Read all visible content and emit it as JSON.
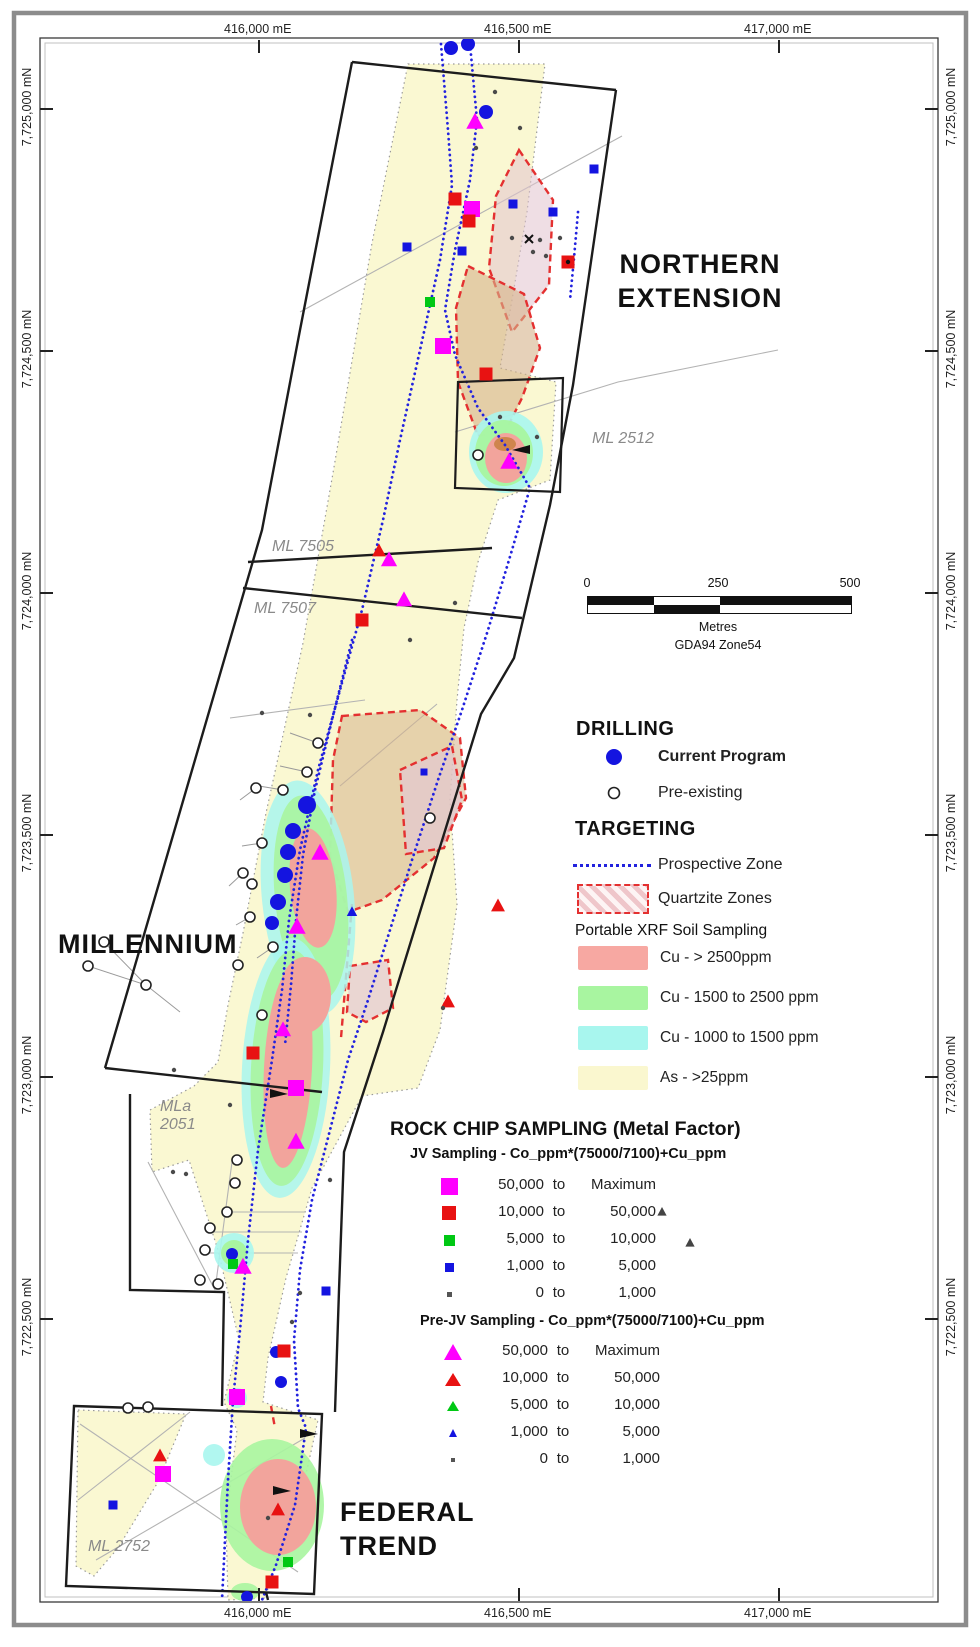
{
  "figure": {
    "areas": {
      "northern": [
        "NORTHERN",
        "EXTENSION"
      ],
      "millennium": "MILLENNIUM",
      "federal": [
        "FEDERAL",
        "TREND"
      ]
    },
    "leases": {
      "ml2512": "ML 2512",
      "ml7505": "ML 7505",
      "ml7507": "ML 7507",
      "mla2051": [
        "MLa",
        "2051"
      ],
      "ml2752": "ML 2752"
    }
  },
  "axes": {
    "eastings": [
      {
        "label": "416,000 mE",
        "x": 258
      },
      {
        "label": "416,500 mE",
        "x": 518
      },
      {
        "label": "417,000 mE",
        "x": 778
      }
    ],
    "northings": [
      {
        "label": "7,725,000 mN",
        "y": 108
      },
      {
        "label": "7,724,500 mN",
        "y": 350
      },
      {
        "label": "7,724,000 mN",
        "y": 592
      },
      {
        "label": "7,723,500 mN",
        "y": 834
      },
      {
        "label": "7,723,000 mN",
        "y": 1076
      },
      {
        "label": "7,722,500 mN",
        "y": 1318
      }
    ]
  },
  "scalebar": {
    "ticks": [
      {
        "label": "0",
        "x": 587
      },
      {
        "label": "250",
        "x": 718
      },
      {
        "label": "500",
        "x": 850
      }
    ],
    "unit": "Metres",
    "datum": "GDA94 Zone54"
  },
  "legend": {
    "drilling": {
      "title": "DRILLING",
      "current": "Current Program",
      "preexisting": "Pre-existing"
    },
    "targeting": {
      "title": "TARGETING",
      "prospective": "Prospective Zone",
      "quartzite": "Quartzite Zones",
      "soil_title": "Portable XRF Soil Sampling",
      "soil": [
        {
          "color": "#F7A8A2",
          "label": "Cu - > 2500ppm"
        },
        {
          "color": "#A8F5A0",
          "label": "Cu - 1500 to 2500 ppm"
        },
        {
          "color": "#A8F6EE",
          "label": "Cu - 1000 to 1500 ppm"
        },
        {
          "color": "#FAF7CF",
          "label": "As - >25ppm"
        }
      ]
    },
    "rockchip": {
      "title": "ROCK CHIP SAMPLING (Metal Factor)",
      "joiner": "to",
      "jv": {
        "subtitle": "JV Sampling - Co_ppm*(75000/7100)+Cu_ppm",
        "rows": [
          {
            "a": "50,000",
            "b": "Maximum",
            "color": "#FF00FF",
            "size": 17
          },
          {
            "a": "10,000",
            "b": "50,000",
            "color": "#E81212",
            "size": 14
          },
          {
            "a": "5,000",
            "b": "10,000",
            "color": "#00C814",
            "size": 11
          },
          {
            "a": "1,000",
            "b": "5,000",
            "color": "#1414E0",
            "size": 9
          },
          {
            "a": "0",
            "b": "1,000",
            "color": "#555555",
            "size": 5
          }
        ]
      },
      "prejv": {
        "subtitle": "Pre-JV Sampling - Co_ppm*(75000/7100)+Cu_ppm",
        "rows": [
          {
            "a": "50,000",
            "b": "Maximum",
            "color": "#FF00FF",
            "size": 16
          },
          {
            "a": "10,000",
            "b": "50,000",
            "color": "#E81212",
            "size": 13
          },
          {
            "a": "5,000",
            "b": "10,000",
            "color": "#00C814",
            "size": 10
          },
          {
            "a": "1,000",
            "b": "5,000",
            "color": "#1414E0",
            "size": 8
          },
          {
            "a": "0",
            "b": "1,000",
            "color": "#555555",
            "size": 4
          }
        ]
      }
    }
  },
  "colors": {
    "drill_blue": "#1414E0",
    "prospective_blue": "#2222DE",
    "quartzite_red": "#E43030",
    "soil_pink": "#F7A8A2",
    "soil_green": "#A8F5A0",
    "soil_cyan": "#A8F6EE",
    "soil_yellow": "#FAF8D2",
    "magenta": "#FF00FF",
    "red": "#E81212",
    "green": "#00C814",
    "blue": "#1414E0",
    "gray": "#4a4a4a"
  },
  "map": {
    "markers": [
      [
        "drill",
        451,
        48
      ],
      [
        "drill",
        468,
        44
      ],
      [
        "drill",
        486,
        112
      ],
      [
        "drill",
        307,
        805,
        null,
        9
      ],
      [
        "drill",
        293,
        831,
        null,
        8
      ],
      [
        "drill",
        288,
        852,
        null,
        8
      ],
      [
        "drill",
        285,
        875,
        null,
        8
      ],
      [
        "drill",
        278,
        902,
        null,
        8
      ],
      [
        "drill",
        272,
        923,
        null,
        7
      ],
      [
        "drill",
        232,
        1254,
        null,
        6
      ],
      [
        "drill",
        276,
        1352,
        null,
        6
      ],
      [
        "drill",
        281,
        1382,
        null,
        6
      ],
      [
        "drill",
        247,
        1597,
        null,
        6
      ],
      [
        "open",
        478,
        455
      ],
      [
        "open",
        318,
        743
      ],
      [
        "open",
        307,
        772
      ],
      [
        "open",
        283,
        790
      ],
      [
        "open",
        256,
        788
      ],
      [
        "open",
        262,
        843
      ],
      [
        "open",
        243,
        873
      ],
      [
        "open",
        252,
        884
      ],
      [
        "open",
        250,
        917
      ],
      [
        "open",
        273,
        947
      ],
      [
        "open",
        238,
        965
      ],
      [
        "open",
        430,
        818
      ],
      [
        "open",
        88,
        966
      ],
      [
        "open",
        104,
        942
      ],
      [
        "open",
        146,
        985
      ],
      [
        "open",
        237,
        1160
      ],
      [
        "open",
        235,
        1183
      ],
      [
        "open",
        227,
        1212
      ],
      [
        "open",
        210,
        1228
      ],
      [
        "open",
        205,
        1250
      ],
      [
        "open",
        200,
        1280
      ],
      [
        "open",
        218,
        1284
      ],
      [
        "open",
        128,
        1408
      ],
      [
        "open",
        148,
        1407
      ],
      [
        "open",
        262,
        1015
      ],
      [
        "sq",
        472,
        209,
        "#FF00FF",
        16
      ],
      [
        "sq",
        443,
        346,
        "#FF00FF",
        16
      ],
      [
        "sq",
        296,
        1088,
        "#FF00FF",
        16
      ],
      [
        "sq",
        237,
        1397,
        "#FF00FF",
        16
      ],
      [
        "sq",
        163,
        1474,
        "#FF00FF",
        16
      ],
      [
        "sq",
        455,
        199,
        "#E81212",
        13
      ],
      [
        "sq",
        469,
        221,
        "#E81212",
        13
      ],
      [
        "sq",
        486,
        374,
        "#E81212",
        13
      ],
      [
        "sq",
        568,
        262,
        "#E81212",
        13
      ],
      [
        "sq",
        253,
        1053,
        "#E81212",
        13
      ],
      [
        "sq",
        284,
        1351,
        "#E81212",
        13
      ],
      [
        "sq",
        272,
        1582,
        "#E81212",
        13
      ],
      [
        "sq",
        362,
        620,
        "#E81212",
        13
      ],
      [
        "sq",
        430,
        302,
        "#00C814",
        10
      ],
      [
        "sq",
        233,
        1264,
        "#00C814",
        10
      ],
      [
        "sq",
        288,
        1562,
        "#00C814",
        10
      ],
      [
        "sq",
        407,
        247,
        "#1414E0",
        9
      ],
      [
        "sq",
        462,
        251,
        "#1414E0",
        9
      ],
      [
        "sq",
        513,
        204,
        "#1414E0",
        9
      ],
      [
        "sq",
        553,
        212,
        "#1414E0",
        9
      ],
      [
        "sq",
        594,
        169,
        "#1414E0",
        9
      ],
      [
        "sq",
        326,
        1291,
        "#1414E0",
        9
      ],
      [
        "sq",
        113,
        1505,
        "#1414E0",
        9
      ],
      [
        "sq",
        424,
        772,
        "#1414E0",
        7
      ],
      [
        "tr",
        475,
        122,
        "#FF00FF",
        15
      ],
      [
        "tr",
        320,
        853,
        "#FF00FF",
        15
      ],
      [
        "tr",
        297,
        927,
        "#FF00FF",
        15
      ],
      [
        "tr",
        296,
        1142,
        "#FF00FF",
        15
      ],
      [
        "tr",
        243,
        1267,
        "#FF00FF",
        15
      ],
      [
        "tr",
        509,
        462,
        "#FF00FF",
        15
      ],
      [
        "tr",
        389,
        560,
        "#FF00FF",
        14
      ],
      [
        "tr",
        404,
        600,
        "#FF00FF",
        14
      ],
      [
        "tr",
        283,
        1030,
        "#FF00FF",
        14
      ],
      [
        "tr",
        379,
        551,
        "#E81212",
        12
      ],
      [
        "tr",
        448,
        1002,
        "#E81212",
        12
      ],
      [
        "tr",
        498,
        906,
        "#E81212",
        12
      ],
      [
        "tr",
        278,
        1510,
        "#E81212",
        12
      ],
      [
        "tr",
        160,
        1456,
        "#E81212",
        12
      ],
      [
        "tr",
        352,
        912,
        "#1414E0",
        9
      ],
      [
        "tr",
        662,
        1212,
        "#444444",
        8
      ],
      [
        "tr",
        690,
        1243,
        "#444444",
        8
      ],
      [
        "dot",
        495,
        92
      ],
      [
        "dot",
        520,
        128
      ],
      [
        "dot",
        476,
        148
      ],
      [
        "dot",
        540,
        240
      ],
      [
        "dot",
        533,
        252
      ],
      [
        "dot",
        512,
        238
      ],
      [
        "dot",
        546,
        256
      ],
      [
        "dot",
        560,
        238
      ],
      [
        "dot",
        537,
        437
      ],
      [
        "dot",
        500,
        417
      ],
      [
        "dot",
        443,
        1008
      ],
      [
        "dot",
        268,
        1518
      ],
      [
        "dot",
        330,
        1180
      ],
      [
        "dot",
        300,
        1293
      ],
      [
        "dot",
        292,
        1322
      ],
      [
        "dot",
        173,
        1172
      ],
      [
        "dot",
        186,
        1174
      ],
      [
        "dot",
        174,
        1070
      ],
      [
        "dot",
        310,
        715
      ],
      [
        "dot",
        262,
        713
      ],
      [
        "dot",
        410,
        640
      ],
      [
        "dot",
        455,
        603
      ],
      [
        "dot",
        230,
        1105
      ],
      [
        "dot",
        568,
        262,
        "#111111"
      ],
      [
        "x",
        529,
        239
      ],
      [
        "wr",
        521,
        450
      ],
      [
        "wl",
        279,
        1094
      ],
      [
        "wl",
        309,
        1434
      ],
      [
        "wl",
        282,
        1491
      ]
    ]
  }
}
